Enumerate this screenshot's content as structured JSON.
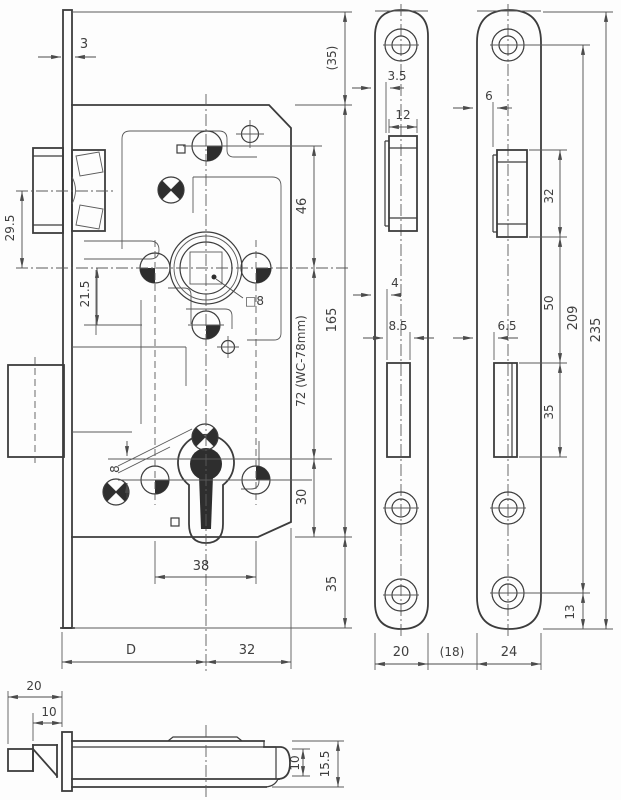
{
  "meta": {
    "description": "Technical dimension drawing of a mortise door lock (case front view, faceplate, strike plate, side view)",
    "drawing_type": "engineering drawing"
  },
  "front_view": {
    "name": "lock case front view",
    "dims": {
      "faceplate_thickness": "3",
      "latch_axis": "29.5",
      "nut_offset": "21.5",
      "follower_square": "□8",
      "top_margin": "(35)",
      "latch_to_spindle": "46",
      "case_length": "165",
      "spindle_to_key": "72  (WC-78mm)",
      "key_offset": "8",
      "key_to_bottom": "30",
      "bottom_margin": "35",
      "hole_spacing": "38",
      "backset": "D",
      "case_depth": "32"
    }
  },
  "faceplate_view": {
    "name": "faceplate front view",
    "dims": {
      "latch_inset": "3.5",
      "latch_cutout_width": "12",
      "bolt_inset": "4",
      "bolt_cutout_width": "8.5",
      "width": "20"
    }
  },
  "gap_dim": "(18)",
  "strike_view": {
    "name": "strike plate view",
    "dims": {
      "latch_inset": "6",
      "latch_cutout_height": "32",
      "cutout_gap": "50",
      "bolt_inset": "6.5",
      "bolt_cutout_height": "35",
      "screw_distance": "209",
      "length": "235",
      "screw_to_end": "13",
      "width": "24"
    }
  },
  "side_view": {
    "name": "lock side view",
    "dims": {
      "latch_head": "20",
      "latch_bevel": "10",
      "case_inner": "10",
      "case_height": "15.5"
    }
  }
}
